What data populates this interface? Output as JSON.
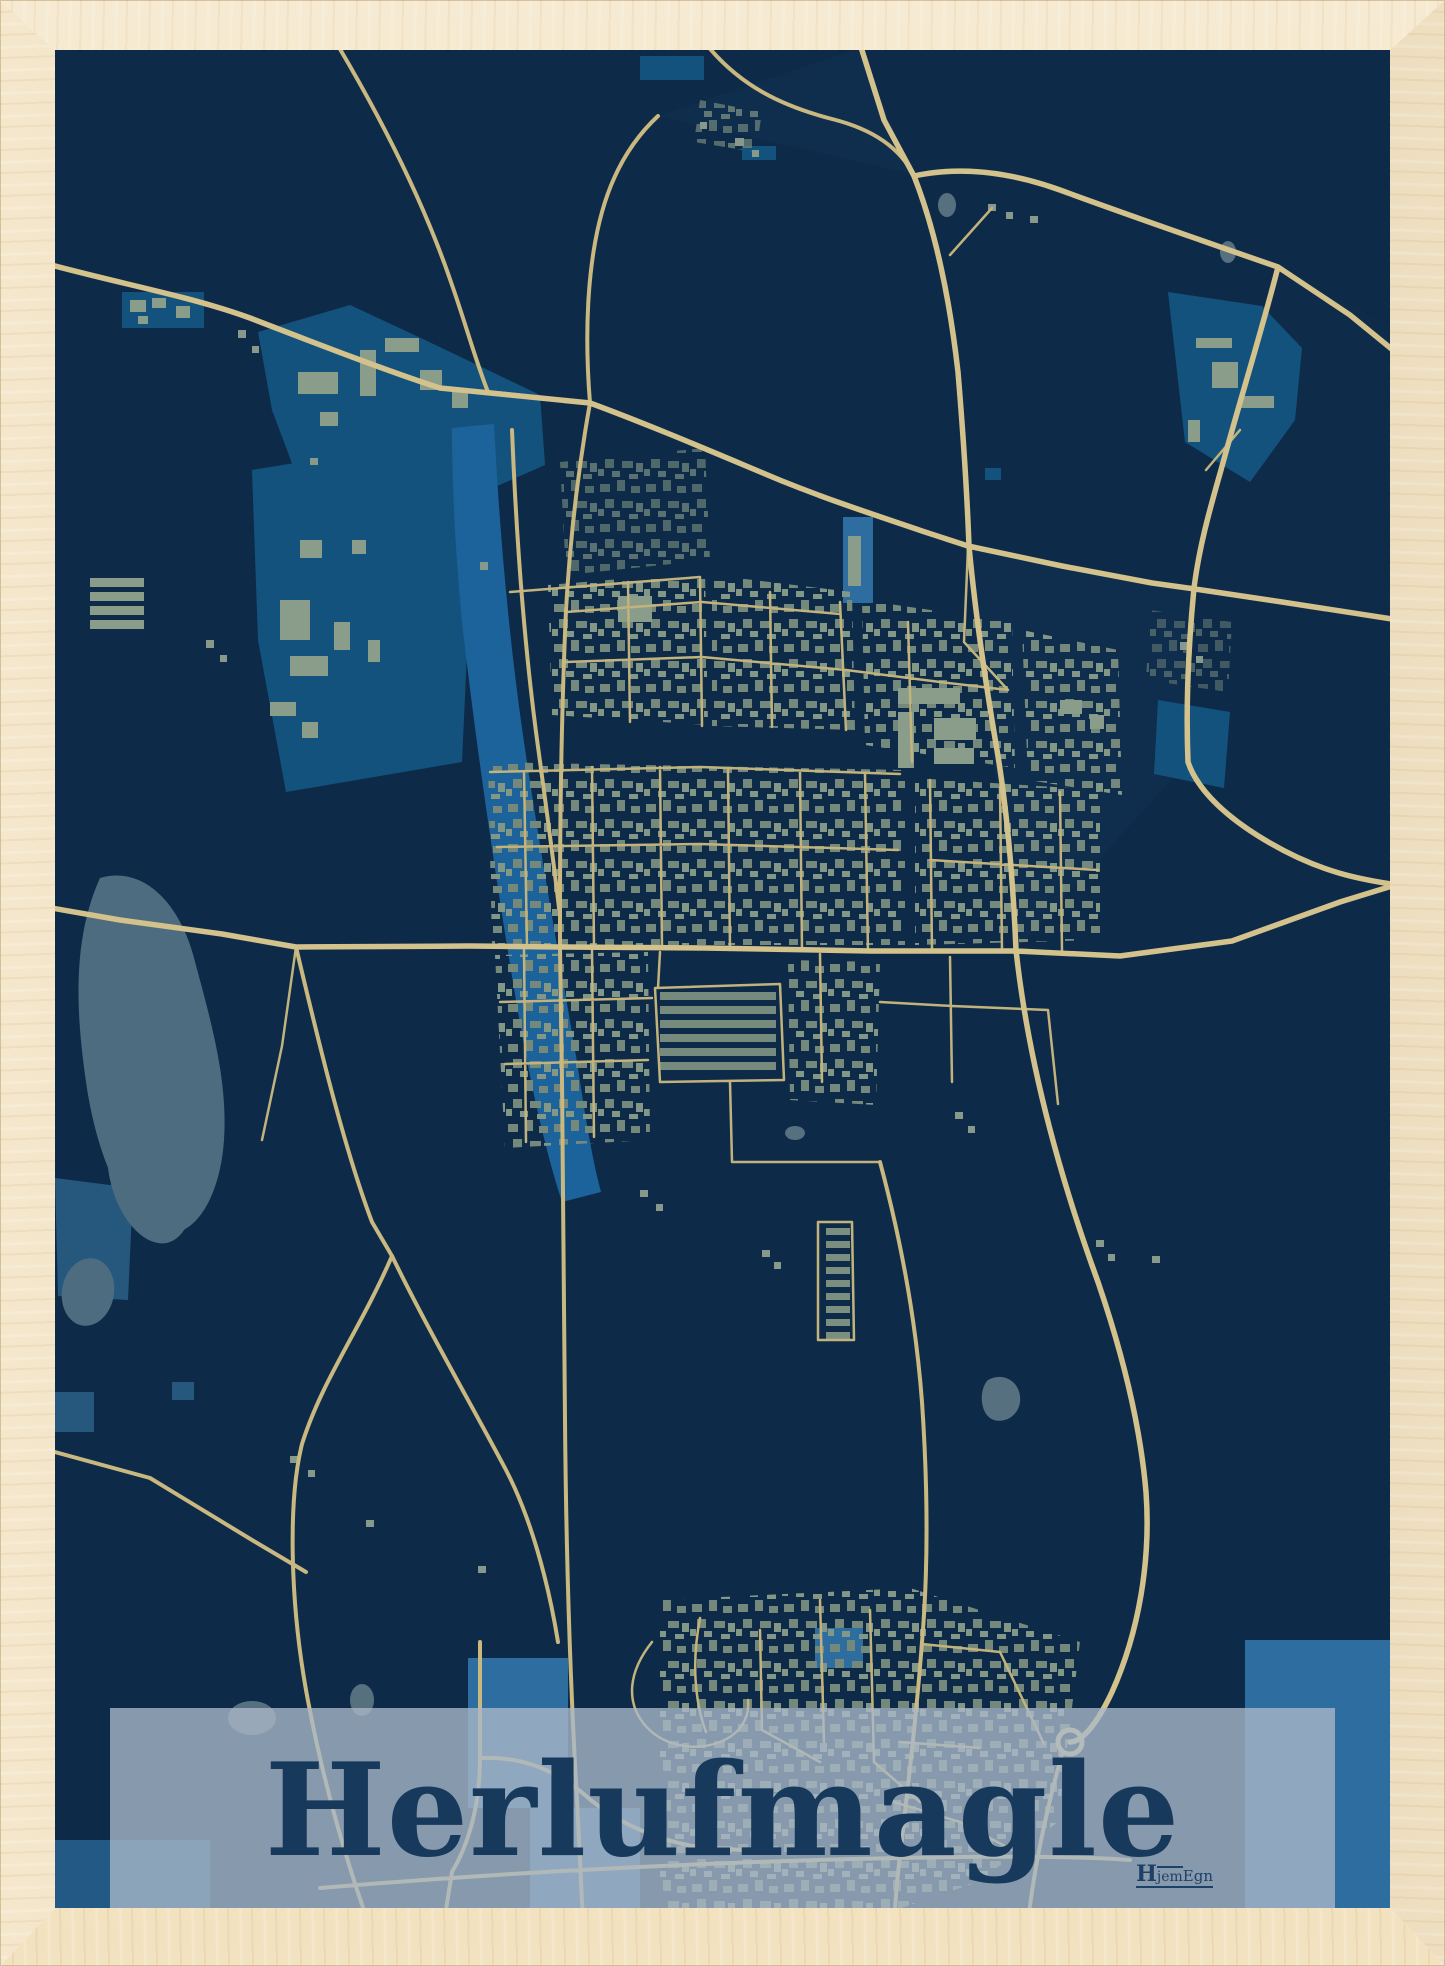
{
  "poster": {
    "title": "Herlufmagle",
    "logo": {
      "h": "H",
      "jem": "jem",
      "egn": "Egn"
    },
    "colors": {
      "map_background": "#0d2b48",
      "zone_blue": "#14527e",
      "zone_blue_bright": "#2e6da0",
      "river_blue": "#1c639c",
      "lake_gray_blue": "#4e6c80",
      "building_sage": "#8a9c8a",
      "road_tan": "#d3c28c",
      "banner_overlay": "rgba(170,184,200,0.78)",
      "title_text": "#16395c",
      "frame_wood": "#ecd9b5"
    }
  }
}
